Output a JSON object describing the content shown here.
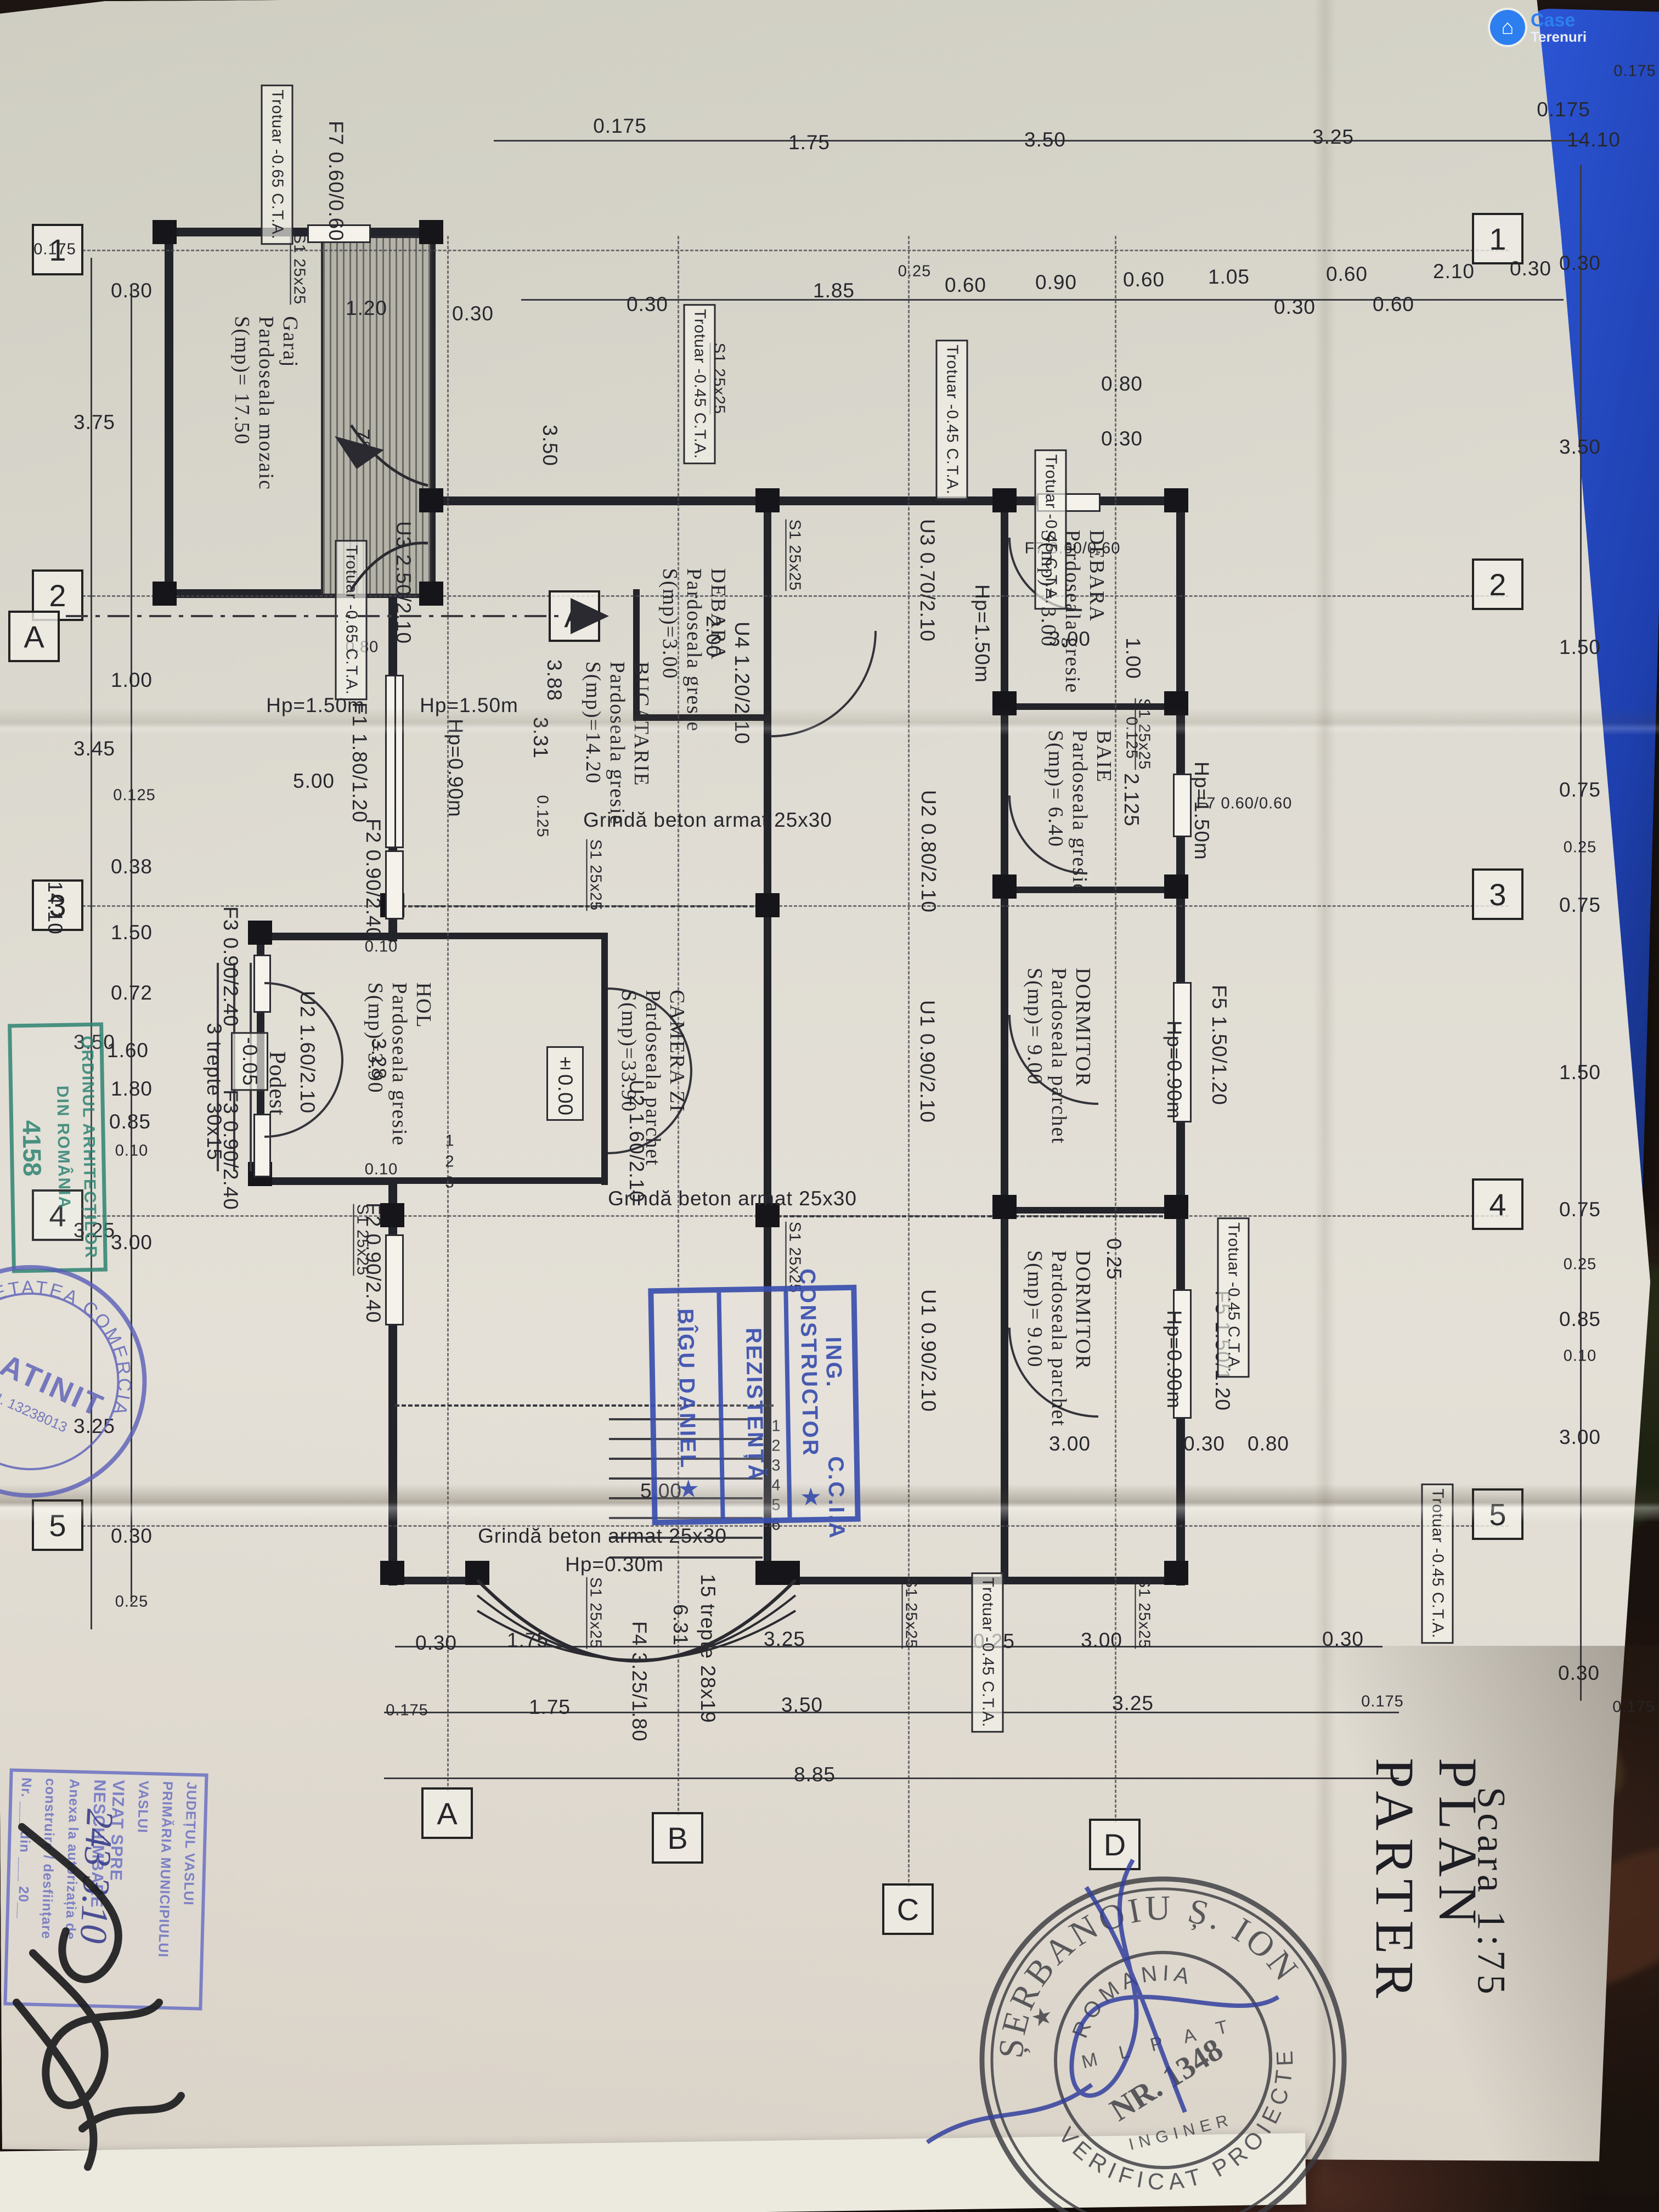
{
  "watermark": {
    "a": "Case",
    "b": "Terenuri"
  },
  "title": {
    "main": "PLAN  PARTER",
    "scale": "Scara 1:75"
  },
  "grid": {
    "nums": [
      "1",
      "2",
      "3",
      "4",
      "5"
    ],
    "lets": [
      "A",
      "B",
      "C",
      "D"
    ],
    "section": "A"
  },
  "rooms": [
    {
      "n": "Garaj",
      "f": "Pardoseala mozaic",
      "a": "S(mp)= 17.50"
    },
    {
      "n": "BUCATARIE",
      "f": "Pardoseala gresie",
      "a": "S(mp)=14.20"
    },
    {
      "n": "DEBARA",
      "f": "Pardoseala gresie",
      "a": "S(mp)=3.00"
    },
    {
      "n": "CAMERA ZI",
      "f": "Pardoseala parchet",
      "a": "S(mp)=33.90"
    },
    {
      "n": "HOL",
      "f": "Pardoseala gresie",
      "a": "S(mp)=3.90"
    },
    {
      "n": "DEBARA",
      "f": "Pardoseala gresie",
      "a": "S(mp)= 3.00"
    },
    {
      "n": "BAIE",
      "f": "Pardoseala gresie",
      "a": "S(mp)= 6.40"
    },
    {
      "n": "DORMITOR",
      "f": "Pardoseala parchet",
      "a": "S(mp)= 9.00"
    },
    {
      "n": "DORMITOR",
      "f": "Pardoseala parchet",
      "a": "S(mp)= 9.00"
    }
  ],
  "doors": [
    "U3 2.50/2.10",
    "U3 0.70/2.10",
    "U4 1.20/2.10",
    "U2 0.80/2.10",
    "U2 1.60/2.10",
    "U2 1.60/2.10",
    "U1 0.90/2.10",
    "U1 0.90/2.10"
  ],
  "windows": [
    "F1 1.80/1.20",
    "F2 0.90/2.40",
    "F2 0.90/2.40",
    "F3 0.90/2.40",
    "F3 0.90/2.40",
    "F4 3.25/1.80",
    "F5 1.50/1.20",
    "F5 1.50/1.20",
    "F7 0.60/0.60",
    "F7 0.60/0.60",
    "F7 0.60/0.60"
  ],
  "levels": {
    "zero": "±0.00",
    "podest_level": "-0.05"
  },
  "beams": {
    "label": "Grindă beton armat 25x30",
    "bay_parapet": "Hp=0.30m"
  },
  "col_label": "S1 25x25",
  "trotuar": [
    "Trotuar  -0.65 C.T.A.",
    "Trotuar  -0.65 C.T.A.",
    "Trotuar  -0.45 C.T.A.",
    "Trotuar  -0.45 C.T.A.",
    "Trotuar  -0.45 C.T.A.",
    "Trotuar  -0.45 C.T.A.",
    "Trotuar  -0.45 C.T.A.",
    "Trotuar  -0.45 C.T.A."
  ],
  "stairs": {
    "main": "15 trepte 28x19",
    "entry": "3 trepte 30x15",
    "podest": "Podest",
    "dim": "6.31",
    "treads": [
      "1",
      "2",
      "3",
      "4",
      "5",
      "6"
    ]
  },
  "ramp": "7°",
  "dims": {
    "tr1": [
      "0.175",
      "1.75",
      "3.50",
      "3.25",
      "0.175"
    ],
    "tr2": [
      "0.30",
      "1.85",
      "0.60",
      "0.90",
      "0.60",
      "1.05",
      "0.30",
      "0.60",
      "0.25",
      "0.60",
      "2.10",
      "0.30"
    ],
    "lo": [
      "0.175",
      "3.75",
      "3.45",
      "3.50",
      "3.25",
      "3.25",
      "14.10"
    ],
    "li": [
      "0.30",
      "1.00",
      "0.125",
      "0.38",
      "1.50",
      "0.72",
      "1.80",
      "1.60",
      "0.85",
      "0.10",
      "3.00",
      "0.30",
      "0.25"
    ],
    "rc": [
      "0.175",
      "14.10",
      "0.30",
      "3.50",
      "1.50",
      "0.75",
      "0.25",
      "0.75",
      "1.50",
      "0.75",
      "0.25",
      "0.85",
      "0.10",
      "3.00",
      "0.30",
      "0.175"
    ],
    "b1": [
      "0.30",
      "1.75",
      "3.25",
      "0.25",
      "3.00",
      "0.30"
    ],
    "b2": [
      "0.175",
      "1.75",
      "3.50",
      "3.25",
      "0.175"
    ],
    "b3": [
      "8.85"
    ],
    "inner": [
      "5.00",
      "Hp=1.50m",
      "Hp=1.50m",
      "3.88",
      "3.31",
      "0.125",
      "Hp=0.90m",
      "1.20",
      "0.30",
      "3.50",
      "1.00",
      "0.125",
      "2.125",
      "3.00",
      "3.00",
      "0.30",
      "0.80",
      "0.25",
      "Hp=0.90m",
      "Hp=0.90m",
      "Hp=1.50m",
      "Hp=1.50m",
      "0.10",
      "0.10",
      "3.28",
      "2.00",
      "0.30",
      "0.80",
      "0.60",
      "0.60",
      "14.10",
      "3.00",
      "0.30",
      "0.80",
      "5.00"
    ]
  },
  "stamps": {
    "round": {
      "top": "ȘERBANOIU Ș. ION",
      "left": "VERIFICAT",
      "bottom": "PROIECTE",
      "c1": "ROMANIA",
      "c2": "M L P A T",
      "c3": "NR. 1348",
      "c4": "INGINER"
    },
    "ccia": {
      "l1": "ING. CONSTRUCTOR",
      "l2": "C.C.I.A  ★",
      "l3": "REZISTENȚĂ",
      "l4": "BÎGU DANIEL ★"
    },
    "ordin": {
      "l1": "ORDINUL ARHITECȚILOR",
      "l2": "DIN ROMÂNIA",
      "num": "4158"
    },
    "platinit": {
      "ring": "SOCIETATEA COMERCIALĂ",
      "name": "PLATINIT",
      "cui": "C.U.I. 13238013"
    },
    "vizat": {
      "l0": "JUDEȚUL VASLUI",
      "l1": "PRIMĂRIA MUNICIPIULUI",
      "l2": "VASLUI",
      "l3": "VIZAT SPRE NESCHIMBARE",
      "l4": "Anexa la autorizația de",
      "l5": "construire / desființare",
      "l6": "Nr. ___ din ___ 20__",
      "hand": "243  3.10"
    }
  }
}
